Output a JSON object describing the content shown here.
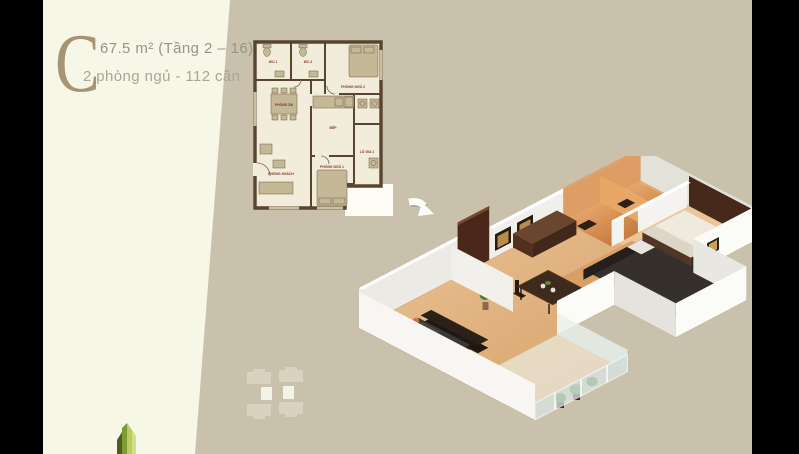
{
  "slide": {
    "unit_letter": "C",
    "area_line": "67.5 m² (Tầng 2 – 16)",
    "detail_line": "2 phòng ngủ - 112 căn"
  },
  "floor_plan": {
    "rooms": [
      {
        "label": "WC.1"
      },
      {
        "label": "WC.2"
      },
      {
        "label": "PHÒNG NGỦ 2"
      },
      {
        "label": "PHÒNG ĂN"
      },
      {
        "label": "BẾP"
      },
      {
        "label": "LÔ GIA 1"
      },
      {
        "label": "PHÒNG KHÁCH"
      },
      {
        "label": "PHÒNG NGỦ 1"
      }
    ]
  },
  "icons": {
    "entrance_arrow": "entrance-arrow-icon",
    "developer_logo": "developer-logo-towers",
    "building_footprint": "building-footprint-keyplan"
  },
  "colors": {
    "frame_black": "#000000",
    "canvas_tan": "#c9c1ac",
    "panel_cream": "#f7f7e8",
    "letter_tan": "#a69473",
    "header_gray": "#94958a",
    "plan_wall_brown": "#594430",
    "plan_floor_cream": "#f2ecda",
    "plan_fixture_tan": "#c5b897",
    "plan_label_maroon": "#7a3a26",
    "render_wall_white": "#f7f6f2",
    "render_floor_wood": "#dca86f",
    "render_bath_copper": "#d98f4e",
    "render_dark_wood": "#4a2719",
    "logo_green_dark": "#4f5c20",
    "logo_green_light": "#b9cc60"
  }
}
